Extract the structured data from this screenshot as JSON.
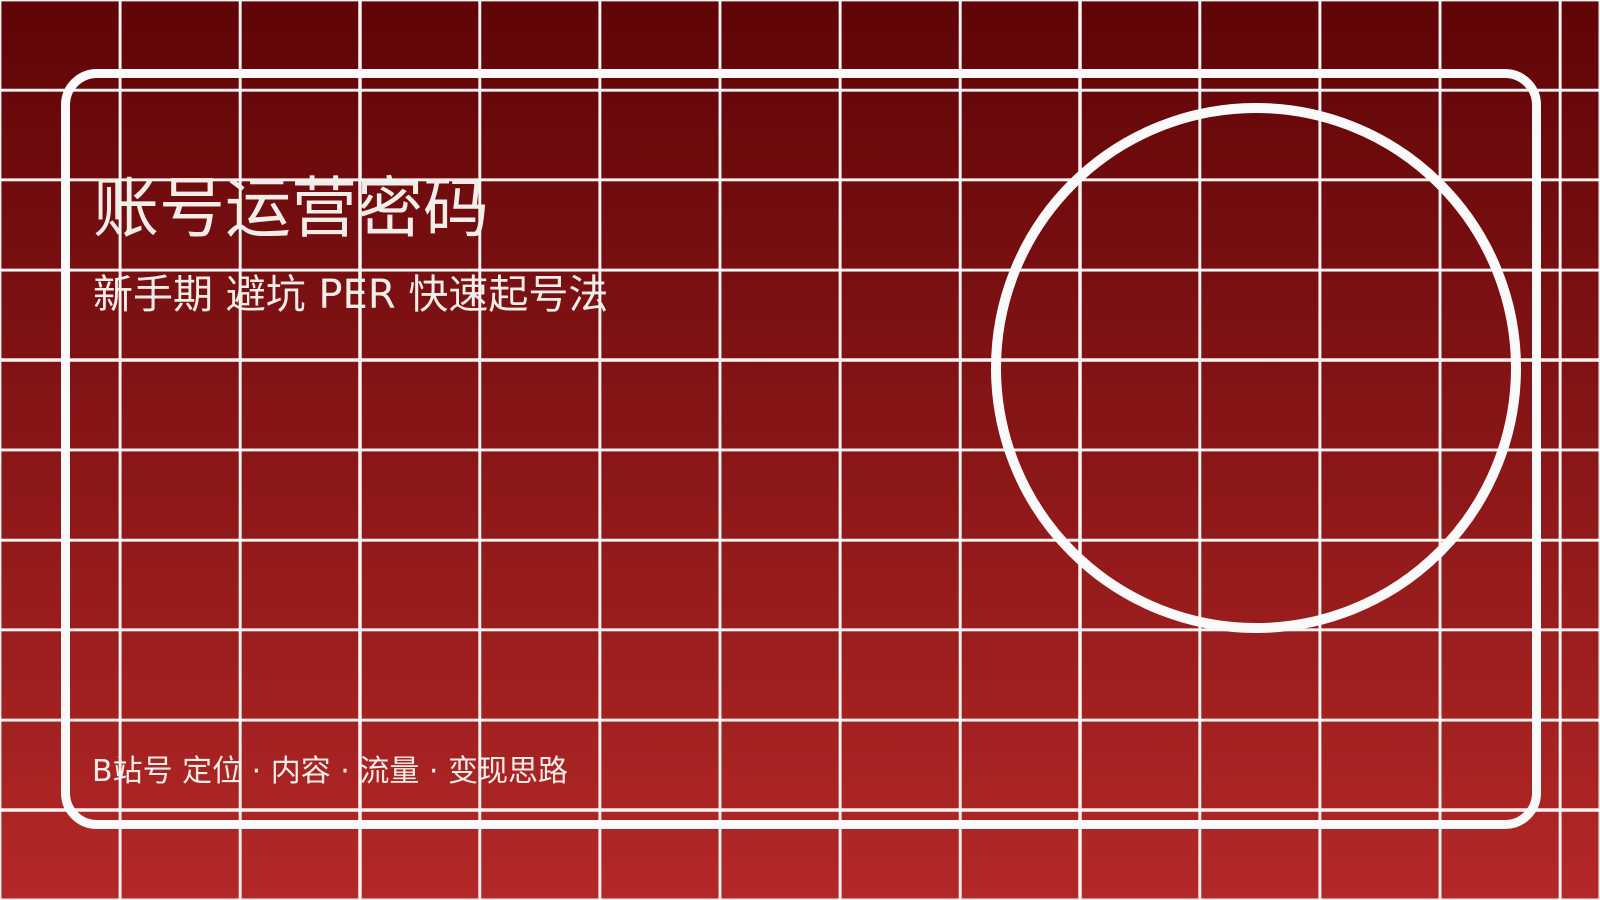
{
  "canvas": {
    "width": 1600,
    "height": 900
  },
  "colors": {
    "bg-top": "#5f0407",
    "bg-bottom": "#b42827",
    "grid-line": "#f7f3f2",
    "frame-stroke": "#fbfafa",
    "text": "#f1ede9"
  },
  "cover": {
    "title": "账号运营密码",
    "subtitle": "新手期 避坑 PER 快速起号法",
    "footer": "B站号 定位 · 内容 · 流量 · 变现思路"
  }
}
